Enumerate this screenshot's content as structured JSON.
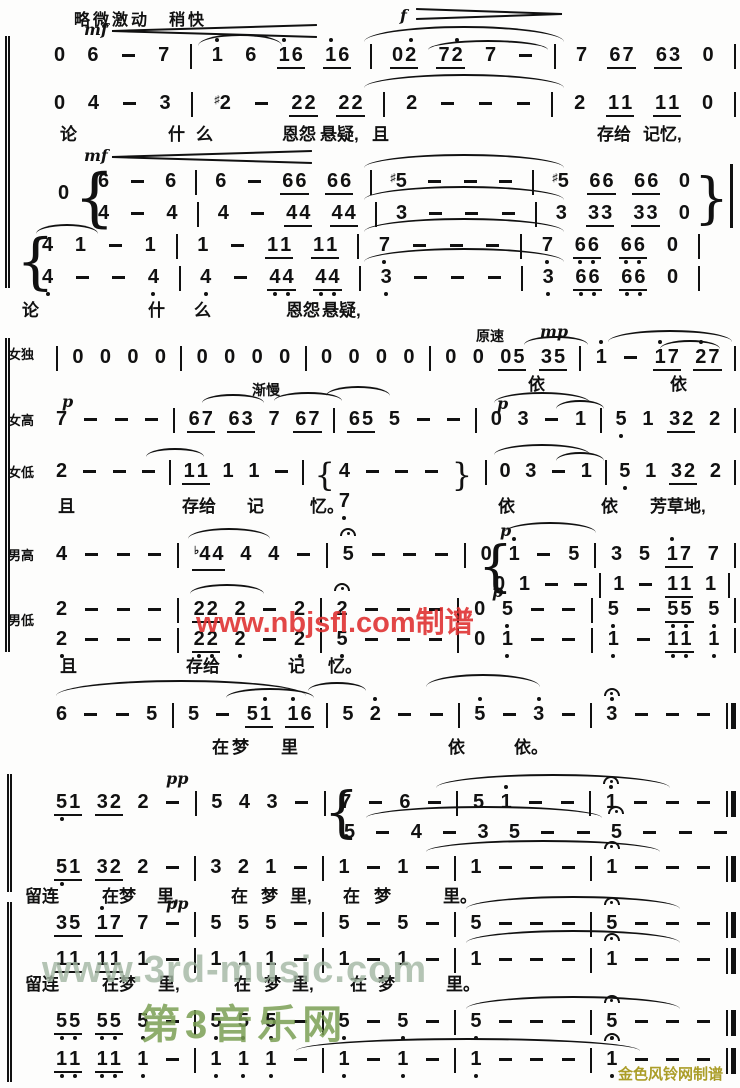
{
  "page": {
    "background": "#fdfdfc",
    "ink": "#111111"
  },
  "header": {
    "tempo_text": "略微激动　稍快"
  },
  "watermarks": {
    "red": "www.nbjsfl.com制谱",
    "red_color": "#e03333",
    "green_url": "www.3rd-music.com",
    "green_url_color": "#a3b7a3",
    "green_brand": "第3音乐网",
    "green_brand_color": "#7ba055",
    "credit": "金色风铃网制谱",
    "credit_color": "#ab9d28"
  },
  "score": {
    "voice_labels": [
      {
        "t": "女独",
        "x": 8,
        "y": 344
      },
      {
        "t": "女高",
        "x": 8,
        "y": 410
      },
      {
        "t": "女低",
        "x": 8,
        "y": 462
      },
      {
        "t": "男高",
        "x": 8,
        "y": 545
      },
      {
        "t": "男低",
        "x": 8,
        "y": 610
      }
    ],
    "dynamics": [
      {
        "t": "mf",
        "x": 84,
        "y": 20,
        "k": "d"
      },
      {
        "t": "f",
        "x": 400,
        "y": 6,
        "k": "d"
      },
      {
        "t": "mf",
        "x": 84,
        "y": 146,
        "k": "d"
      },
      {
        "t": "原速",
        "x": 476,
        "y": 326,
        "k": "t"
      },
      {
        "t": "mp",
        "x": 540,
        "y": 322,
        "k": "d"
      },
      {
        "t": "渐慢",
        "x": 252,
        "y": 380,
        "k": "t"
      },
      {
        "t": "p",
        "x": 62,
        "y": 392,
        "k": "d"
      },
      {
        "t": "p",
        "x": 497,
        "y": 394,
        "k": "d"
      },
      {
        "t": "p",
        "x": 500,
        "y": 521,
        "k": "d"
      },
      {
        "t": "p",
        "x": 492,
        "y": 582,
        "k": "d"
      },
      {
        "t": "pp",
        "x": 166,
        "y": 769,
        "k": "d"
      },
      {
        "t": "pp",
        "x": 166,
        "y": 894,
        "k": "d"
      }
    ],
    "hairpins": [
      {
        "x": 112,
        "y": 24,
        "w": 205,
        "h": 12,
        "dir": "cresc"
      },
      {
        "x": 416,
        "y": 8,
        "w": 146,
        "h": 10,
        "dir": "dim"
      },
      {
        "x": 112,
        "y": 150,
        "w": 200,
        "h": 12,
        "dir": "cresc"
      }
    ],
    "system_bars": [
      {
        "x": 5,
        "y": 36,
        "h": 252
      },
      {
        "x": 5,
        "y": 338,
        "h": 314
      },
      {
        "x": 7,
        "y": 774,
        "h": 118
      },
      {
        "x": 7,
        "y": 902,
        "h": 180
      }
    ],
    "free_symbols": [
      {
        "t": "0",
        "x": 58,
        "y": 182,
        "k": "n"
      },
      {
        "t": "{",
        "x": 74,
        "y": 163,
        "h": 70,
        "k": "b"
      },
      {
        "t": "}",
        "x": 694,
        "y": 168,
        "h": 60,
        "k": "b"
      },
      {
        "t": "|",
        "x": 730,
        "y": 164,
        "h": 64,
        "k": "v"
      },
      {
        "t": "{",
        "x": 16,
        "y": 229,
        "h": 66,
        "k": "b"
      },
      {
        "t": "{",
        "x": 478,
        "y": 536,
        "h": 60,
        "k": "b"
      },
      {
        "t": "{",
        "x": 324,
        "y": 782,
        "h": 60,
        "k": "b"
      }
    ],
    "slurs": [
      {
        "x": 198,
        "y": 34,
        "w": 84,
        "h": 12
      },
      {
        "x": 364,
        "y": 26,
        "w": 200,
        "h": 16
      },
      {
        "x": 428,
        "y": 40,
        "w": 120,
        "h": 10
      },
      {
        "x": 364,
        "y": 74,
        "w": 200,
        "h": 14
      },
      {
        "x": 364,
        "y": 154,
        "w": 200,
        "h": 14
      },
      {
        "x": 364,
        "y": 186,
        "w": 200,
        "h": 14
      },
      {
        "x": 364,
        "y": 218,
        "w": 200,
        "h": 14
      },
      {
        "x": 364,
        "y": 248,
        "w": 200,
        "h": 14
      },
      {
        "x": 36,
        "y": 224,
        "w": 62,
        "h": 10
      },
      {
        "x": 524,
        "y": 336,
        "w": 64,
        "h": 9
      },
      {
        "x": 608,
        "y": 330,
        "w": 124,
        "h": 12
      },
      {
        "x": 660,
        "y": 340,
        "w": 60,
        "h": 9
      },
      {
        "x": 202,
        "y": 394,
        "w": 62,
        "h": 9
      },
      {
        "x": 274,
        "y": 392,
        "w": 68,
        "h": 9
      },
      {
        "x": 326,
        "y": 386,
        "w": 64,
        "h": 10
      },
      {
        "x": 494,
        "y": 392,
        "w": 96,
        "h": 11
      },
      {
        "x": 556,
        "y": 400,
        "w": 48,
        "h": 9
      },
      {
        "x": 146,
        "y": 448,
        "w": 58,
        "h": 9
      },
      {
        "x": 494,
        "y": 444,
        "w": 96,
        "h": 11
      },
      {
        "x": 556,
        "y": 452,
        "w": 48,
        "h": 9
      },
      {
        "x": 188,
        "y": 528,
        "w": 82,
        "h": 11
      },
      {
        "x": 504,
        "y": 522,
        "w": 92,
        "h": 11
      },
      {
        "x": 190,
        "y": 584,
        "w": 74,
        "h": 10
      },
      {
        "x": 56,
        "y": 680,
        "w": 250,
        "h": 16
      },
      {
        "x": 226,
        "y": 688,
        "w": 88,
        "h": 10
      },
      {
        "x": 308,
        "y": 682,
        "w": 58,
        "h": 9
      },
      {
        "x": 426,
        "y": 674,
        "w": 114,
        "h": 13
      },
      {
        "x": 436,
        "y": 774,
        "w": 234,
        "h": 14
      },
      {
        "x": 366,
        "y": 806,
        "w": 236,
        "h": 12
      },
      {
        "x": 426,
        "y": 840,
        "w": 234,
        "h": 12
      },
      {
        "x": 466,
        "y": 896,
        "w": 214,
        "h": 13
      },
      {
        "x": 466,
        "y": 930,
        "w": 214,
        "h": 13
      },
      {
        "x": 466,
        "y": 996,
        "w": 214,
        "h": 13
      },
      {
        "x": 296,
        "y": 1038,
        "w": 344,
        "h": 13
      }
    ],
    "lines": [
      {
        "name": "voice1",
        "x": 52,
        "y": 44,
        "w": 684,
        "tokens": "0 6 - 7 | 1' 6 _1'6 _1'6 | _02' _72' 7 - | 7 _67 _63 0 |"
      },
      {
        "name": "voice2",
        "x": 52,
        "y": 92,
        "w": 684,
        "tokens": "0 4 - 3 | #2 - _22 _22 | 2 - - - | 2 _11 _11 0 |"
      },
      {
        "name": "chorus-upper-a",
        "x": 96,
        "y": 170,
        "w": 596,
        "tokens": "6 - 6 | 6 - _66 _66 | #5 - - - | #5 _66 _66 0"
      },
      {
        "name": "chorus-lower-a",
        "x": 96,
        "y": 202,
        "w": 596,
        "tokens": "4 - 4 | 4 - _44 _44 | 3 - - - | 3 _33 _33 0"
      },
      {
        "name": "chorus-upper-b",
        "x": 40,
        "y": 234,
        "w": 660,
        "tokens": "4 1 - 1 | 1 - _11 _11 | 7. - - - | 7. _6.6. _6.6. 0 |"
      },
      {
        "name": "chorus-lower-b",
        "x": 40,
        "y": 266,
        "w": 660,
        "tokens": "4. - - 4. | 4. - _4.4. _4.4. | 3. - - - | 3. _6.6. _6.6. 0 |"
      },
      {
        "name": "female-solo",
        "x": 56,
        "y": 346,
        "w": 680,
        "tokens": "| 0 0 0 0 | 0 0 0 0 | 0 0 0 0 | 0 0 _05 _35 | 1' - _1'7 _2'7 |"
      },
      {
        "name": "soprano",
        "x": 54,
        "y": 408,
        "w": 682,
        "tokens": "7 - - - | _67 _63 7 _67 | _65 5 - - | 0 3 - 1 | 5. 1 _32 2 |"
      },
      {
        "name": "alto",
        "x": 54,
        "y": 460,
        "w": 682,
        "tokens": "2 - - - | _11 1 1 - | {4/7. - - - } | 0 3 - 1 | 5. 1 _32 2 |"
      },
      {
        "name": "tenor",
        "x": 54,
        "y": 543,
        "w": 682,
        "tokens": "4 - - - | b_44 4 4 - | 5^ - - - | 0 1' - 5 | 3 5 _1'7 7 |"
      },
      {
        "name": "tenor-lower",
        "x": 492,
        "y": 573,
        "w": 238,
        "tokens": "0 1 - - | 1 - _11 1 |"
      },
      {
        "name": "bass-upper",
        "x": 54,
        "y": 598,
        "w": 682,
        "tokens": "2 - - - | _22 2 - 2 | 2^ - - - | 0 5. - - | 5. - _5.5. 5. |"
      },
      {
        "name": "bass-lower",
        "x": 54,
        "y": 628,
        "w": 682,
        "tokens": "2. - - - | _2.2. 2. - 2. | 5. - - - | 0 1. - - | 1. - _1.1. 1. |"
      },
      {
        "name": "unison",
        "x": 54,
        "y": 703,
        "w": 682,
        "tokens": "6 - - 5 | 5 - _51' _1'6 | 5 2' - - | 5' - 3' - | 3'^ - - - ||"
      },
      {
        "name": "upper-line-2a",
        "x": 54,
        "y": 791,
        "w": 682,
        "tokens": "_5.1 _32 2 - | 5 4 3 - | 7 - 6 - | 5 1' - - | 1'^ - - - ||"
      },
      {
        "name": "upper-line-2a-sub",
        "x": 342,
        "y": 821,
        "w": 388,
        "tokens": "5 - 4 - 3 5 - - 5^ - - -"
      },
      {
        "name": "lower-line-2b",
        "x": 54,
        "y": 856,
        "w": 682,
        "tokens": "_5.1 _32 2 - | 3 2 1 - | 1 - 1 - | 1 - - - | 1^ - - - ||"
      },
      {
        "name": "final-line-1",
        "x": 54,
        "y": 912,
        "w": 682,
        "tokens": "_35 _1'7 7 - | 5 5 5 - | 5 - 5 - | 5 - - - | 5^ - - - ||"
      },
      {
        "name": "final-line-2",
        "x": 54,
        "y": 948,
        "w": 682,
        "tokens": "_11 _11 1 - | 1 1 1 - | 1 - 1 - | 1 - - - | 1^ - - - ||"
      },
      {
        "name": "final-line-3",
        "x": 54,
        "y": 1010,
        "w": 682,
        "tokens": "_5.5. _5.5. 5. - | 5. 5. 5. - | 5. - 5. - | 5. - - - | 5.^ - - - ||"
      },
      {
        "name": "final-line-4",
        "x": 54,
        "y": 1048,
        "w": 682,
        "tokens": "_1.1. _1.1. 1. - | 1. 1. 1. - | 1. - 1. - | 1. - - - | 1.^ - - - ||"
      }
    ],
    "lyrics": [
      {
        "y": 120,
        "items": [
          {
            "t": "论",
            "x": 60
          },
          {
            "t": "什",
            "x": 168
          },
          {
            "t": "么",
            "x": 196
          },
          {
            "t": "恩怨",
            "x": 282
          },
          {
            "t": "悬疑,",
            "x": 320
          },
          {
            "t": "且",
            "x": 372
          },
          {
            "t": "存给",
            "x": 597
          },
          {
            "t": "记忆,",
            "x": 643
          }
        ]
      },
      {
        "y": 296,
        "items": [
          {
            "t": "论",
            "x": 22
          },
          {
            "t": "什",
            "x": 148
          },
          {
            "t": "么",
            "x": 194
          },
          {
            "t": "恩怨",
            "x": 286
          },
          {
            "t": "悬疑,",
            "x": 322
          }
        ]
      },
      {
        "y": 370,
        "items": [
          {
            "t": "依",
            "x": 528
          },
          {
            "t": "依",
            "x": 670
          }
        ]
      },
      {
        "y": 492,
        "items": [
          {
            "t": "且",
            "x": 58
          },
          {
            "t": "存给",
            "x": 182
          },
          {
            "t": "记",
            "x": 247
          },
          {
            "t": "忆。",
            "x": 310
          },
          {
            "t": "依",
            "x": 498
          },
          {
            "t": "依",
            "x": 601
          },
          {
            "t": "芳草地,",
            "x": 650
          }
        ]
      },
      {
        "y": 652,
        "items": [
          {
            "t": "且",
            "x": 60
          },
          {
            "t": "存给",
            "x": 186
          },
          {
            "t": "记",
            "x": 288
          },
          {
            "t": "忆。",
            "x": 328
          }
        ]
      },
      {
        "y": 733,
        "items": [
          {
            "t": "在",
            "x": 212
          },
          {
            "t": "梦",
            "x": 232
          },
          {
            "t": "里",
            "x": 281
          },
          {
            "t": "依",
            "x": 448
          },
          {
            "t": "依。",
            "x": 514
          }
        ]
      },
      {
        "y": 882,
        "items": [
          {
            "t": "留连",
            "x": 25
          },
          {
            "t": "在梦",
            "x": 102
          },
          {
            "t": "里,",
            "x": 157
          },
          {
            "t": "在",
            "x": 231
          },
          {
            "t": "梦",
            "x": 261
          },
          {
            "t": "里,",
            "x": 290
          },
          {
            "t": "在",
            "x": 343
          },
          {
            "t": "梦",
            "x": 374
          },
          {
            "t": "里。",
            "x": 443
          }
        ]
      },
      {
        "y": 970,
        "items": [
          {
            "t": "留连",
            "x": 25
          },
          {
            "t": "在梦",
            "x": 102
          },
          {
            "t": "里,",
            "x": 158
          },
          {
            "t": "在",
            "x": 234
          },
          {
            "t": "梦",
            "x": 264
          },
          {
            "t": "里,",
            "x": 292
          },
          {
            "t": "在",
            "x": 350
          },
          {
            "t": "梦",
            "x": 378
          },
          {
            "t": "里。",
            "x": 446
          }
        ]
      }
    ]
  }
}
